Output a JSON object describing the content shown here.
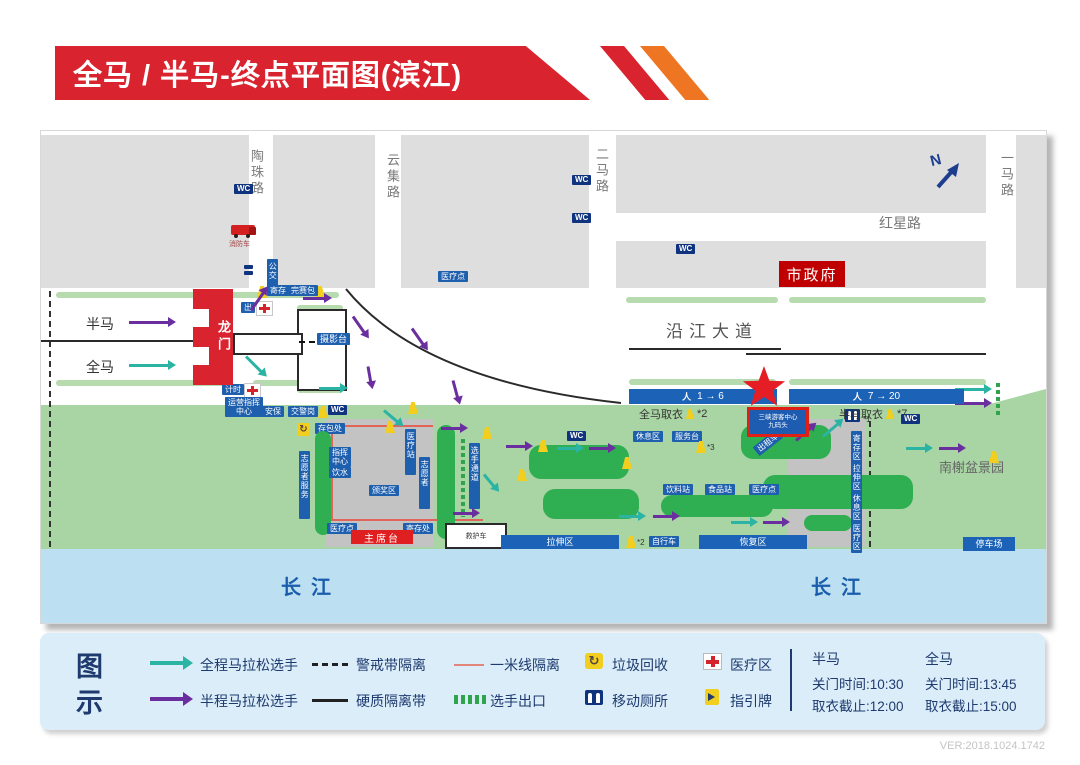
{
  "title": "全马 / 半马-终点平面图(滨江)",
  "version": "VER:2018.1024.1742",
  "compass": "N",
  "map": {
    "wc_label": "WC",
    "city_hall": "市政府",
    "gate": "龙门",
    "stage": "主席台",
    "river": "长江",
    "pier": [
      "三峡游客中心",
      "九码头"
    ],
    "bars": {
      "full": {
        "range": "1 → 6",
        "label": "全马取衣",
        "note": "*2"
      },
      "half": {
        "range": "7 → 20",
        "label": "半马取衣",
        "note": "*7"
      }
    },
    "streets": [
      {
        "t": "sv",
        "x": 206,
        "y": 18,
        "s": "陶珠路",
        "n": "street-taozhu-road"
      },
      {
        "t": "sv",
        "x": 342,
        "y": 22,
        "s": "云集路",
        "n": "street-yunji-road"
      },
      {
        "t": "sv",
        "x": 551,
        "y": 16,
        "s": "二马路",
        "n": "street-erma-road"
      },
      {
        "t": "sv",
        "x": 956,
        "y": 20,
        "s": "一马路",
        "n": "street-yima-road"
      },
      {
        "t": "tx",
        "x": 838,
        "y": 82,
        "s": "红星路",
        "fs": 14,
        "c": "#787878",
        "n": "street-hongxing-road"
      },
      {
        "t": "tx",
        "x": 625,
        "y": 186,
        "s": "沿江大道",
        "fs": 17,
        "c": "#555555",
        "ls": 6,
        "n": "street-yanjiang-avenue"
      }
    ],
    "items": [
      {
        "t": "bl",
        "x": 0,
        "y": 4,
        "w": 208,
        "h": 153
      },
      {
        "t": "bl",
        "x": 232,
        "y": 4,
        "w": 102,
        "h": 153
      },
      {
        "t": "bl",
        "x": 360,
        "y": 4,
        "w": 188,
        "h": 153
      },
      {
        "t": "bl",
        "x": 575,
        "y": 4,
        "w": 370,
        "h": 78
      },
      {
        "t": "bl",
        "x": 575,
        "y": 110,
        "w": 370,
        "h": 47
      },
      {
        "t": "bl",
        "x": 975,
        "y": 4,
        "w": 30,
        "h": 153
      },
      {
        "t": "wc",
        "x": 193,
        "y": 53
      },
      {
        "t": "wc",
        "x": 531,
        "y": 44
      },
      {
        "t": "wc",
        "x": 531,
        "y": 82
      },
      {
        "t": "wc",
        "x": 635,
        "y": 113
      },
      {
        "t": "wc",
        "x": 526,
        "y": 300
      },
      {
        "t": "wc",
        "x": 860,
        "y": 283
      },
      {
        "t": "wc",
        "x": 287,
        "y": 274
      },
      {
        "t": "tk",
        "x": 190,
        "y": 94,
        "n": "fire-truck-icon"
      },
      {
        "t": "tx",
        "x": 188,
        "y": 108,
        "s": "消防车",
        "fs": 7,
        "c": "#a34040"
      },
      {
        "t": "car",
        "x": 203,
        "y": 134,
        "n": "bus-icons"
      },
      {
        "t": "vt",
        "x": 226,
        "y": 128,
        "h": 24,
        "s": "公交"
      },
      {
        "t": "dv",
        "x": 8,
        "y": 160,
        "h": 256
      },
      {
        "t": "dv",
        "x": 828,
        "y": 290,
        "h": 126
      },
      {
        "t": "cb",
        "x": 15,
        "y": 161,
        "w": 283
      },
      {
        "t": "cb",
        "x": 585,
        "y": 166,
        "w": 152
      },
      {
        "t": "cb",
        "x": 748,
        "y": 166,
        "w": 197
      },
      {
        "t": "cb",
        "x": 15,
        "y": 249,
        "w": 172
      },
      {
        "t": "cb",
        "x": 212,
        "y": 249,
        "w": 88
      },
      {
        "t": "cb",
        "x": 588,
        "y": 248,
        "w": 147
      },
      {
        "t": "cb",
        "x": 748,
        "y": 248,
        "w": 197
      },
      {
        "t": "cb",
        "x": 256,
        "y": 174,
        "w": 46
      },
      {
        "t": "cb",
        "x": 256,
        "y": 256,
        "w": 46
      },
      {
        "t": "ln",
        "x": 0,
        "y": 209,
        "w": 153
      },
      {
        "t": "ln",
        "x": 588,
        "y": 217,
        "w": 152
      },
      {
        "t": "ln",
        "x": 705,
        "y": 222,
        "w": 240
      },
      {
        "t": "tx",
        "x": 45,
        "y": 183,
        "s": "半马",
        "fs": 14,
        "c": "#333333",
        "n": "half-marathon-lane-label"
      },
      {
        "t": "tx",
        "x": 45,
        "y": 226,
        "s": "全马",
        "fs": 14,
        "c": "#333333",
        "n": "full-marathon-lane-label"
      },
      {
        "t": "tg",
        "x": 397,
        "y": 140,
        "s": "医疗点"
      },
      {
        "t": "tg",
        "x": 200,
        "y": 171,
        "s": "出"
      },
      {
        "t": "cr",
        "x": 215,
        "y": 170
      },
      {
        "t": "cn",
        "x": 216,
        "y": 155
      },
      {
        "t": "cn",
        "x": 274,
        "y": 155
      },
      {
        "t": "tg",
        "x": 226,
        "y": 154,
        "s": "寄存"
      },
      {
        "t": "tg",
        "x": 247,
        "y": 154,
        "s": "完赛包"
      },
      {
        "t": "wb",
        "x": 256,
        "y": 178,
        "w": 46,
        "h": 78,
        "s": "",
        "n": "grandstand"
      },
      {
        "t": "wb",
        "x": 192,
        "y": 202,
        "w": 66,
        "h": 18,
        "s": "",
        "n": "finish-chute"
      },
      {
        "t": "dl",
        "x": 258,
        "y": 210,
        "w": 16
      },
      {
        "t": "tg",
        "x": 276,
        "y": 202,
        "s": "摄影台",
        "fs": 9,
        "n": "photo-platform-tag"
      },
      {
        "t": "tg",
        "x": 181,
        "y": 253,
        "s": "计时"
      },
      {
        "t": "cr",
        "x": 203,
        "y": 252
      },
      {
        "t": "t2",
        "x": 184,
        "y": 266,
        "a": "运营指挥",
        "b": "中心"
      },
      {
        "t": "tg",
        "x": 221,
        "y": 275,
        "s": "安保"
      },
      {
        "t": "tg",
        "x": 247,
        "y": 275,
        "s": "交警岗"
      },
      {
        "t": "cn",
        "x": 277,
        "y": 275
      },
      {
        "t": "ex",
        "x": 955,
        "y": 252,
        "h": 32,
        "n": "runner-exit-marks"
      },
      {
        "t": "ex",
        "x": 420,
        "y": 308,
        "h": 78,
        "n": "runner-exit-marks"
      },
      {
        "t": "rl",
        "x": 290,
        "y": 294,
        "w": 102,
        "dir": "h"
      },
      {
        "t": "rl",
        "x": 290,
        "y": 294,
        "w": 96,
        "dir": "v"
      },
      {
        "t": "rl",
        "x": 290,
        "y": 388,
        "w": 152,
        "dir": "h"
      },
      {
        "t": "rc",
        "x": 256,
        "y": 292,
        "n": "recycle-icon"
      },
      {
        "t": "tg",
        "x": 274,
        "y": 292,
        "s": "存包处"
      },
      {
        "t": "vt",
        "x": 258,
        "y": 320,
        "h": 62,
        "s": "志愿者服务"
      },
      {
        "t": "bu",
        "x": 274,
        "y": 300,
        "w": 16,
        "h": 104
      },
      {
        "t": "bu",
        "x": 396,
        "y": 294,
        "w": 18,
        "h": 114
      },
      {
        "t": "vt",
        "x": 428,
        "y": 312,
        "h": 60,
        "s": "选手通道"
      },
      {
        "t": "t2",
        "x": 288,
        "y": 316,
        "a": "指挥",
        "b": "中心"
      },
      {
        "t": "tg",
        "x": 288,
        "y": 336,
        "s": "饮水"
      },
      {
        "t": "tg",
        "x": 328,
        "y": 354,
        "s": "颁奖区"
      },
      {
        "t": "vt",
        "x": 364,
        "y": 298,
        "h": 40,
        "s": "医疗站"
      },
      {
        "t": "vt",
        "x": 378,
        "y": 326,
        "h": 46,
        "s": "志愿者"
      },
      {
        "t": "tg",
        "x": 286,
        "y": 392,
        "s": "医疗点"
      },
      {
        "t": "tg",
        "x": 362,
        "y": 392,
        "s": "寄存处"
      },
      {
        "t": "wb",
        "x": 404,
        "y": 392,
        "w": 58,
        "h": 22,
        "s": "救护车",
        "n": "ambulance-box"
      },
      {
        "t": "bu",
        "x": 488,
        "y": 314,
        "w": 100,
        "h": 34
      },
      {
        "t": "bu",
        "x": 502,
        "y": 358,
        "w": 96,
        "h": 30
      },
      {
        "t": "bu",
        "x": 700,
        "y": 294,
        "w": 90,
        "h": 34
      },
      {
        "t": "bu",
        "x": 722,
        "y": 344,
        "w": 150,
        "h": 34
      },
      {
        "t": "bu",
        "x": 763,
        "y": 384,
        "w": 48,
        "h": 16
      },
      {
        "t": "bu",
        "x": 620,
        "y": 364,
        "w": 112,
        "h": 22
      },
      {
        "t": "tg",
        "x": 592,
        "y": 300,
        "s": "休息区"
      },
      {
        "t": "tg",
        "x": 631,
        "y": 300,
        "s": "服务台"
      },
      {
        "t": "cn",
        "x": 655,
        "y": 310
      },
      {
        "t": "tx",
        "x": 666,
        "y": 312,
        "s": "*3",
        "fs": 8,
        "c": "#333333"
      },
      {
        "t": "tg",
        "x": 622,
        "y": 353,
        "s": "饮料站"
      },
      {
        "t": "tg",
        "x": 664,
        "y": 353,
        "s": "食品站"
      },
      {
        "t": "tg",
        "x": 708,
        "y": 353,
        "s": "医疗点"
      },
      {
        "t": "tg",
        "x": 712,
        "y": 306,
        "s": "出租车",
        "rot": -38
      },
      {
        "t": "bb",
        "x": 460,
        "y": 404,
        "w": 118,
        "s": "拉伸区"
      },
      {
        "t": "cn",
        "x": 585,
        "y": 405
      },
      {
        "t": "tx",
        "x": 596,
        "y": 407,
        "s": "*2",
        "fs": 8,
        "c": "#333333"
      },
      {
        "t": "tg",
        "x": 608,
        "y": 405,
        "s": "自行车"
      },
      {
        "t": "bb",
        "x": 658,
        "y": 404,
        "w": 108,
        "s": "恢复区"
      },
      {
        "t": "bb",
        "x": 922,
        "y": 406,
        "w": 52,
        "s": "停车场"
      },
      {
        "t": "pp",
        "x": 804,
        "y": 278,
        "n": "mobile-toilet-icon"
      },
      {
        "t": "tx",
        "x": 822,
        "y": 284,
        "s": "*1",
        "fs": 8,
        "c": "#333333"
      },
      {
        "t": "vt",
        "x": 810,
        "y": 300,
        "h": 28,
        "s": "寄存区"
      },
      {
        "t": "vt",
        "x": 810,
        "y": 330,
        "h": 28,
        "s": "拉伸区"
      },
      {
        "t": "vt",
        "x": 810,
        "y": 360,
        "h": 28,
        "s": "休息区"
      },
      {
        "t": "vt",
        "x": 810,
        "y": 390,
        "h": 26,
        "s": "医疗区"
      },
      {
        "t": "tx",
        "x": 898,
        "y": 326,
        "s": "南榭盆景园",
        "fs": 13,
        "c": "#666666",
        "n": "bonsai-garden-label"
      },
      {
        "t": "cn",
        "x": 367,
        "y": 271
      },
      {
        "t": "cn",
        "x": 344,
        "y": 290
      },
      {
        "t": "cn",
        "x": 441,
        "y": 296
      },
      {
        "t": "cn",
        "x": 476,
        "y": 338
      },
      {
        "t": "cn",
        "x": 497,
        "y": 309
      },
      {
        "t": "cn",
        "x": 581,
        "y": 326
      },
      {
        "t": "cn",
        "x": 750,
        "y": 285
      },
      {
        "t": "cn",
        "x": 948,
        "y": 320
      }
    ],
    "arrows": [
      [
        88,
        190,
        40,
        0,
        "p"
      ],
      [
        88,
        233,
        40,
        0,
        "t"
      ],
      [
        210,
        178,
        22,
        -55,
        "p"
      ],
      [
        205,
        224,
        22,
        45,
        "t"
      ],
      [
        262,
        166,
        22,
        0,
        "p"
      ],
      [
        371,
        196,
        20,
        55,
        "p"
      ],
      [
        412,
        248,
        18,
        75,
        "p"
      ],
      [
        312,
        184,
        20,
        55,
        "p"
      ],
      [
        327,
        234,
        16,
        80,
        "p"
      ],
      [
        278,
        256,
        22,
        0,
        "t"
      ],
      [
        914,
        257,
        30,
        0,
        "t"
      ],
      [
        914,
        271,
        30,
        0,
        "p"
      ],
      [
        343,
        278,
        18,
        40,
        "t"
      ],
      [
        400,
        296,
        20,
        0,
        "p"
      ],
      [
        443,
        342,
        16,
        50,
        "t"
      ],
      [
        412,
        381,
        20,
        0,
        "p"
      ],
      [
        465,
        314,
        20,
        0,
        "p"
      ],
      [
        516,
        316,
        20,
        0,
        "t"
      ],
      [
        548,
        316,
        20,
        0,
        "p"
      ],
      [
        578,
        384,
        20,
        0,
        "t"
      ],
      [
        612,
        384,
        20,
        0,
        "p"
      ],
      [
        690,
        390,
        20,
        0,
        "t"
      ],
      [
        722,
        390,
        20,
        0,
        "p"
      ],
      [
        755,
        308,
        20,
        -40,
        "p"
      ],
      [
        782,
        304,
        20,
        -40,
        "t"
      ],
      [
        865,
        316,
        20,
        0,
        "t"
      ],
      [
        898,
        316,
        20,
        0,
        "p"
      ]
    ]
  },
  "legend": {
    "title": "图示",
    "full_runner": "全程马拉松选手",
    "half_runner": "半程马拉松选手",
    "cordon": "警戒带隔离",
    "hard_barrier": "硬质隔离带",
    "one_meter": "一米线隔离",
    "runner_exit": "选手出口",
    "garbage": "垃圾回收",
    "toilet": "移动厕所",
    "medical": "医疗区",
    "guide_sign": "指引牌",
    "times": {
      "half": {
        "name": "半马",
        "close": "关门时间:10:30",
        "clothes": "取衣截止:12:00"
      },
      "full": {
        "name": "全马",
        "close": "关门时间:13:45",
        "clothes": "取衣截止:15:00"
      }
    }
  }
}
